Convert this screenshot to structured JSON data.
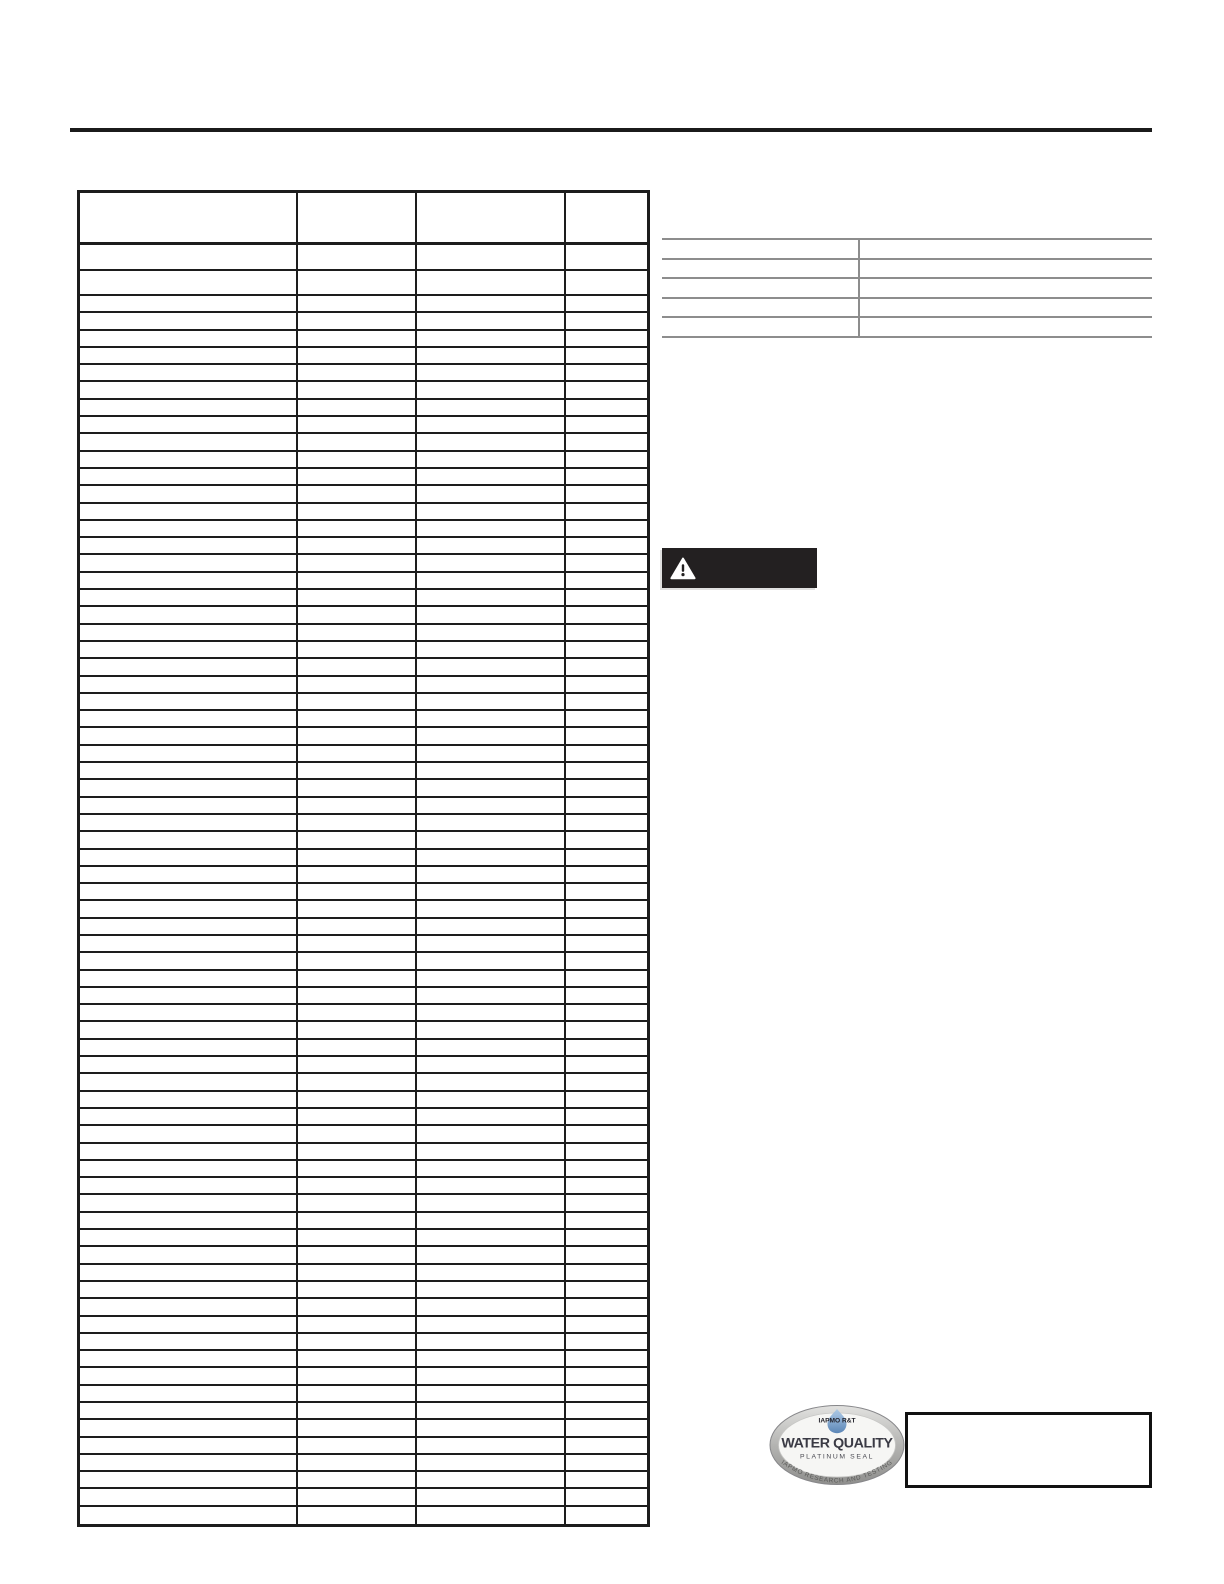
{
  "page": {
    "background": "#ffffff"
  },
  "top_rule": {
    "color": "#1b1b1b"
  },
  "main_table": {
    "column_count": 4,
    "row_count": 73,
    "border_color": "#1d1d1d",
    "headers": [
      "",
      "",
      "",
      ""
    ]
  },
  "side_table": {
    "column_count": 2,
    "row_count": 5,
    "line_color": "#8d8d8d"
  },
  "warning_banner": {
    "background": "#232021",
    "icon": "warning-triangle-icon",
    "label": ""
  },
  "seal": {
    "top_label": "IAPMO R&T",
    "title": "WATER QUALITY",
    "subtitle": "PLATINUM SEAL",
    "arc_text": "IAPMO RESEARCH AND TESTING",
    "drop_color": "#4a79b0",
    "rim_color": "#a8a8a6",
    "text_color": "#3a3a44"
  },
  "cert_box": {
    "border_color": "#111111"
  }
}
